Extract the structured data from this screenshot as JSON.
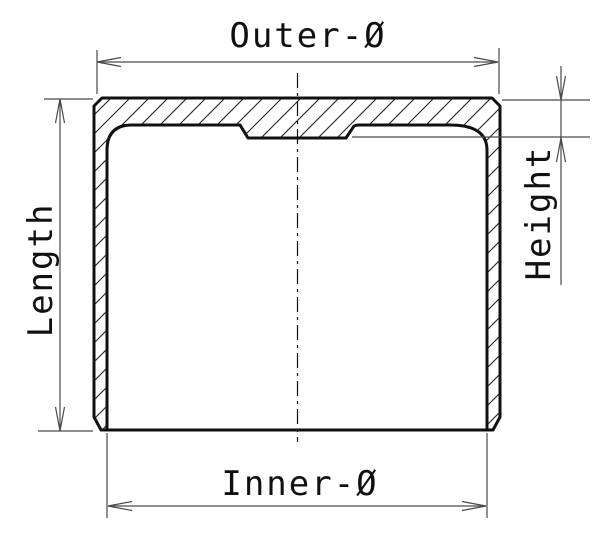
{
  "drawing": {
    "kind": "technical cross-section diagram",
    "labels": {
      "outer_diameter": "Outer-Ø",
      "inner_diameter": "Inner-Ø",
      "length": "Length",
      "height": "Height"
    },
    "colors": {
      "background": "#ffffff",
      "outline": "#101010",
      "dimension_line": "#4a4a4a",
      "hatch": "#222222"
    }
  }
}
